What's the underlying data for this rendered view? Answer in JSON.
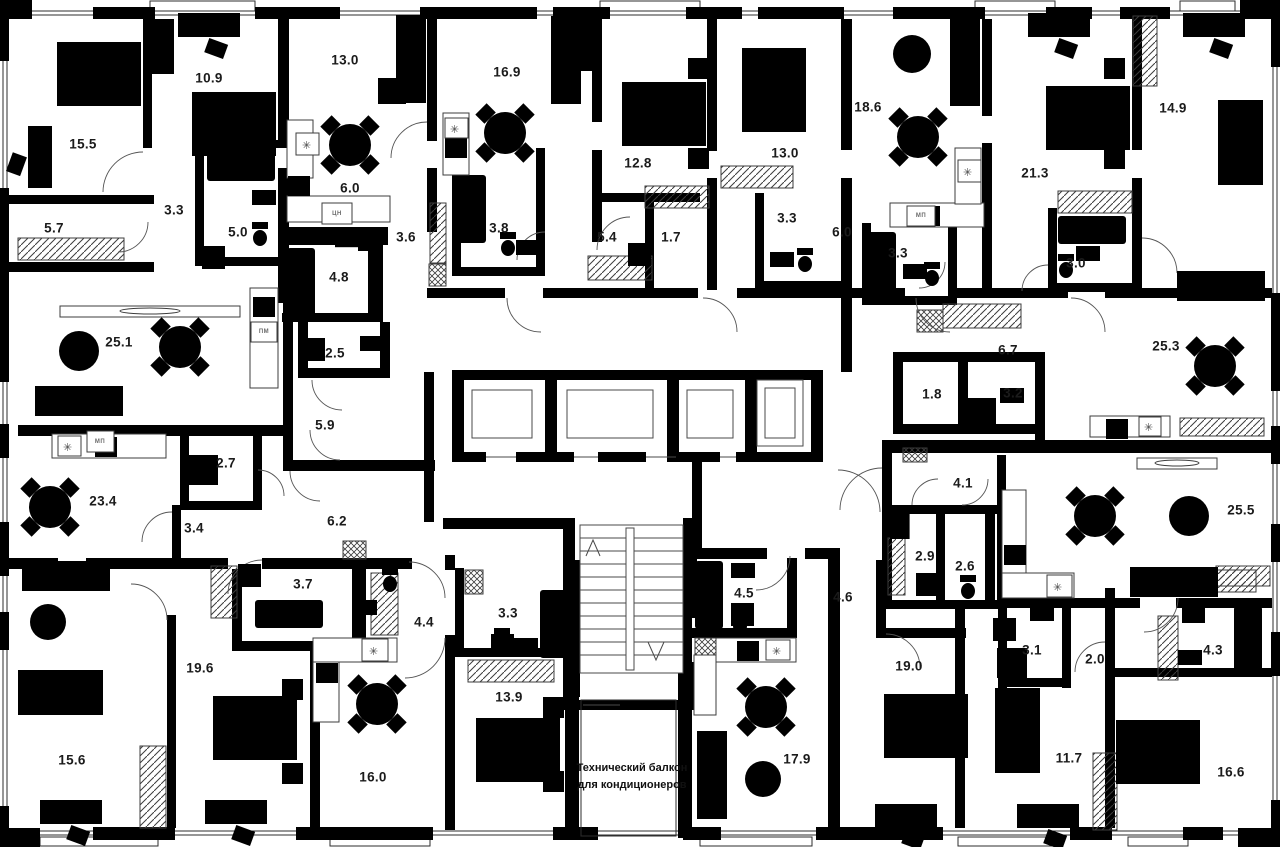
{
  "plan": {
    "type": "residential-floor-plan",
    "background_color": "#ffffff",
    "wall_color": "#000000",
    "label_color": "#1b1b1b",
    "note": {
      "line1": "Технический балкон",
      "line2": "для кондиционеров",
      "x": 630,
      "y": 781
    },
    "room_labels": [
      {
        "t": "15.5",
        "x": 83,
        "y": 144
      },
      {
        "t": "10.9",
        "x": 209,
        "y": 78
      },
      {
        "t": "13.0",
        "x": 345,
        "y": 60
      },
      {
        "t": "16.9",
        "x": 507,
        "y": 72
      },
      {
        "t": "12.8",
        "x": 638,
        "y": 163
      },
      {
        "t": "13.0",
        "x": 785,
        "y": 153
      },
      {
        "t": "18.6",
        "x": 868,
        "y": 107
      },
      {
        "t": "21.3",
        "x": 1035,
        "y": 173
      },
      {
        "t": "14.9",
        "x": 1173,
        "y": 108
      },
      {
        "t": "5.7",
        "x": 54,
        "y": 228
      },
      {
        "t": "3.3",
        "x": 174,
        "y": 210
      },
      {
        "t": "5.0",
        "x": 238,
        "y": 232
      },
      {
        "t": "6.0",
        "x": 350,
        "y": 188
      },
      {
        "t": "3.6",
        "x": 406,
        "y": 237
      },
      {
        "t": "4.8",
        "x": 339,
        "y": 277
      },
      {
        "t": "3.8",
        "x": 499,
        "y": 228
      },
      {
        "t": "5.4",
        "x": 607,
        "y": 237
      },
      {
        "t": "1.7",
        "x": 671,
        "y": 237
      },
      {
        "t": "3.3",
        "x": 787,
        "y": 218
      },
      {
        "t": "6.0",
        "x": 842,
        "y": 232
      },
      {
        "t": "3.3",
        "x": 898,
        "y": 253
      },
      {
        "t": "3.0",
        "x": 1076,
        "y": 263
      },
      {
        "t": "25.1",
        "x": 119,
        "y": 342
      },
      {
        "t": "2.5",
        "x": 335,
        "y": 353
      },
      {
        "t": "5.9",
        "x": 325,
        "y": 425
      },
      {
        "t": "2.7",
        "x": 226,
        "y": 463
      },
      {
        "t": "23.4",
        "x": 103,
        "y": 501
      },
      {
        "t": "3.4",
        "x": 194,
        "y": 528
      },
      {
        "t": "6.2",
        "x": 337,
        "y": 521
      },
      {
        "t": "6.7",
        "x": 1008,
        "y": 350
      },
      {
        "t": "1.8",
        "x": 932,
        "y": 394
      },
      {
        "t": "3.2",
        "x": 1013,
        "y": 393
      },
      {
        "t": "25.3",
        "x": 1166,
        "y": 346
      },
      {
        "t": "4.1",
        "x": 963,
        "y": 483
      },
      {
        "t": "2.9",
        "x": 925,
        "y": 556
      },
      {
        "t": "2.6",
        "x": 965,
        "y": 566
      },
      {
        "t": "25.5",
        "x": 1241,
        "y": 510
      },
      {
        "t": "3.7",
        "x": 303,
        "y": 584
      },
      {
        "t": "19.6",
        "x": 200,
        "y": 668
      },
      {
        "t": "15.6",
        "x": 72,
        "y": 760
      },
      {
        "t": "16.0",
        "x": 373,
        "y": 777
      },
      {
        "t": "4.4",
        "x": 424,
        "y": 622
      },
      {
        "t": "3.3",
        "x": 508,
        "y": 613
      },
      {
        "t": "13.9",
        "x": 509,
        "y": 697
      },
      {
        "t": "4.5",
        "x": 744,
        "y": 593
      },
      {
        "t": "4.6",
        "x": 843,
        "y": 597
      },
      {
        "t": "17.9",
        "x": 797,
        "y": 759
      },
      {
        "t": "19.0",
        "x": 909,
        "y": 666
      },
      {
        "t": "3.1",
        "x": 1032,
        "y": 650
      },
      {
        "t": "2.0",
        "x": 1095,
        "y": 659
      },
      {
        "t": "4.3",
        "x": 1213,
        "y": 650
      },
      {
        "t": "11.7",
        "x": 1069,
        "y": 758
      },
      {
        "t": "16.6",
        "x": 1231,
        "y": 772
      }
    ],
    "appliance_labels": [
      {
        "t": "ЦН",
        "x": 337,
        "y": 214
      },
      {
        "t": "ПМ",
        "x": 264,
        "y": 332
      },
      {
        "t": "МП",
        "x": 100,
        "y": 442
      },
      {
        "t": "МП",
        "x": 921,
        "y": 216
      }
    ]
  }
}
